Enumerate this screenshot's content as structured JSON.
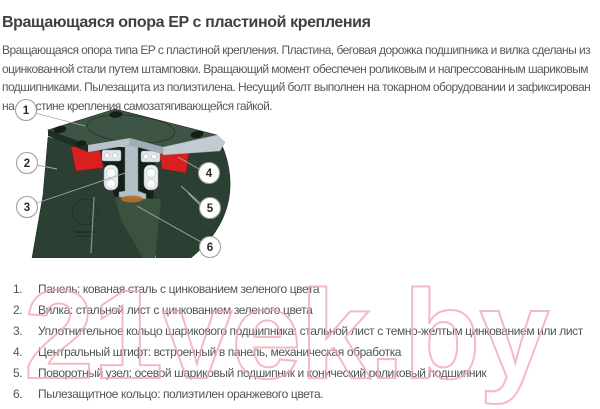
{
  "page": {
    "title": "Вращающаяся опора EP с пластиной крепления",
    "description": "Вращающаяся опора типа EP с пластиной крепления. Пластина, беговая дорожка подшипника и вилка сделаны из оцинкованной стали путем штамповки. Вращающий момент обеспечен роликовым и напрессованным шариковым подшипниками. Пылезащита из полиэтилена. Несущий болт выполнен на токарном оборудовании и зафиксирован на пластине крепления самозатягивающейся гайкой."
  },
  "colors": {
    "plate_green": "#3e5444",
    "fork_green": "#2b4032",
    "cavity_dark": "#151f17",
    "seal_red": "#d92020",
    "steel": "#b4c0c8",
    "leader_gray": "#a9a9a9",
    "watermark_pink": "#f2aab5"
  },
  "diagram": {
    "callouts": [
      {
        "label": "1"
      },
      {
        "label": "2"
      },
      {
        "label": "3"
      },
      {
        "label": "4"
      },
      {
        "label": "5"
      },
      {
        "label": "6"
      }
    ]
  },
  "parts_list": [
    {
      "number": "1.",
      "text": "Панель: кованая сталь с цинкованием зеленого цвета"
    },
    {
      "number": "2.",
      "text": "Вилка: стальной лист с цинкованием зеленого цвета"
    },
    {
      "number": "3.",
      "text": "Уплотнительное кольцо шарикового подшипника: стальной лист с темно-желтым цинкованием или лист"
    },
    {
      "number": "4.",
      "text": "Центральный штифт: встроенный в панель, механическая обработка"
    },
    {
      "number": "5.",
      "text": "Поворотный узел: осевой шариковый подшипник и конический роликовый подшипник"
    },
    {
      "number": "6.",
      "text": "Пылезащитное кольцо: полиэтилен оранжевого цвета."
    }
  ],
  "watermark": {
    "text": "21vek.by"
  }
}
